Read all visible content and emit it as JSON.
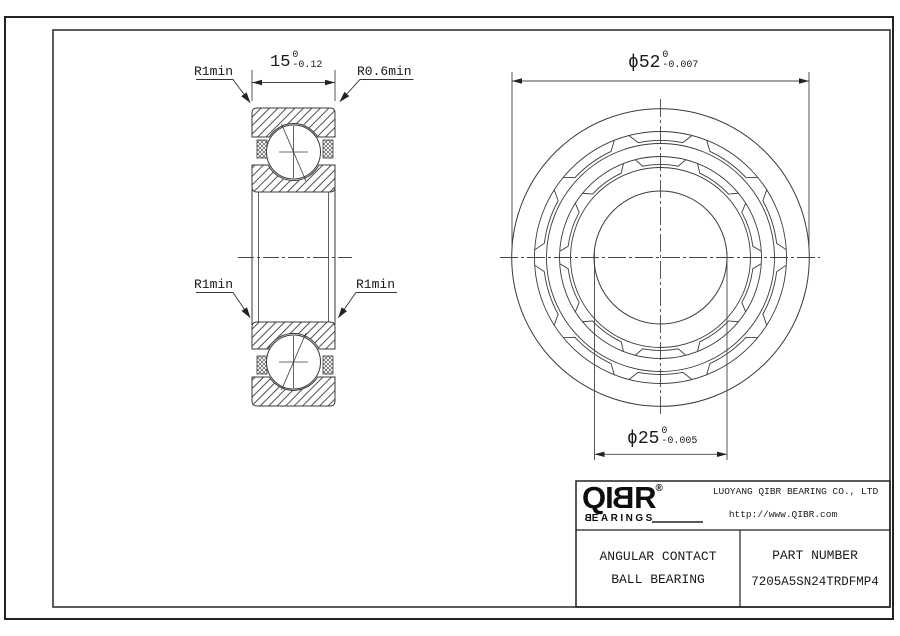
{
  "colors": {
    "line": "#3a3a3a",
    "text": "#1a1a1a",
    "frame": "#222222",
    "background": "#ffffff"
  },
  "view_section": {
    "width_dim": {
      "value": "15",
      "tol_upper": "0",
      "tol_lower": "-0.12"
    },
    "fillet_top_left": "R1min",
    "fillet_top_right": "R0.6min",
    "fillet_bottom_left": "R1min",
    "fillet_bottom_right": "R1min"
  },
  "view_front": {
    "outer_dia_dim": {
      "symbol": "ϕ",
      "value": "52",
      "tol_upper": "0",
      "tol_lower": "-0.007"
    },
    "bore_dia_dim": {
      "symbol": "ϕ",
      "value": "25",
      "tol_upper": "0",
      "tol_lower": "-0.005"
    }
  },
  "title_block": {
    "logo": {
      "prefix": "QI",
      "mirrored_letter": "B",
      "suffix": "R",
      "registered": "®",
      "subtitle_rest": "EARINGS"
    },
    "company": "LUOYANG QIBR BEARING CO., LTD",
    "website": "http://www.QIBR.com",
    "product_line1": "ANGULAR CONTACT",
    "product_line2": "BALL BEARING",
    "part_number_label": "PART NUMBER",
    "part_number": "7205A5SN24TRDFMP4"
  }
}
